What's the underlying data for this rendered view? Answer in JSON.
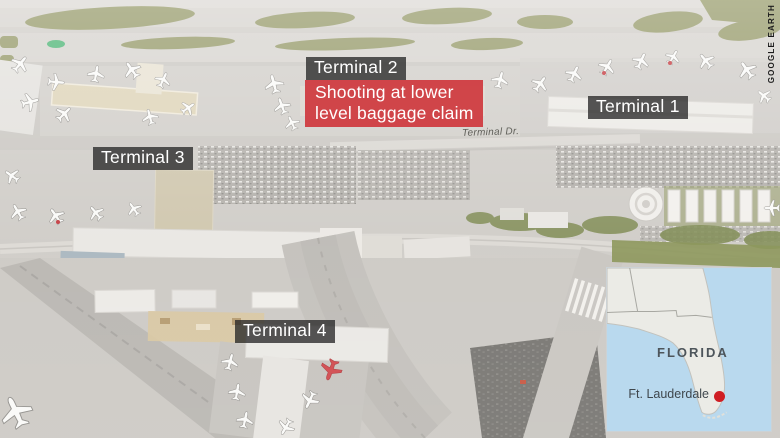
{
  "credit": "GOOGLE EARTH",
  "map_labels": {
    "terminal1": "Terminal 1",
    "terminal2": "Terminal 2",
    "terminal3": "Terminal 3",
    "terminal4": "Terminal 4",
    "road": "Terminal Dr."
  },
  "alert": {
    "text": "Shooting at lower\nlevel baggage claim",
    "color": "rgba(206,52,58,0.9)"
  },
  "labels_style": {
    "background": "rgba(40,40,40,0.78)",
    "text_color": "#ffffff"
  },
  "inset": {
    "state_label": "FLORIDA",
    "city_label": "Ft. Lauderdale",
    "marker_color": "#cf1d23",
    "water_color": "#b9d9ee",
    "land_color": "#ebebe6",
    "border_line_color": "#a8a8a2"
  }
}
